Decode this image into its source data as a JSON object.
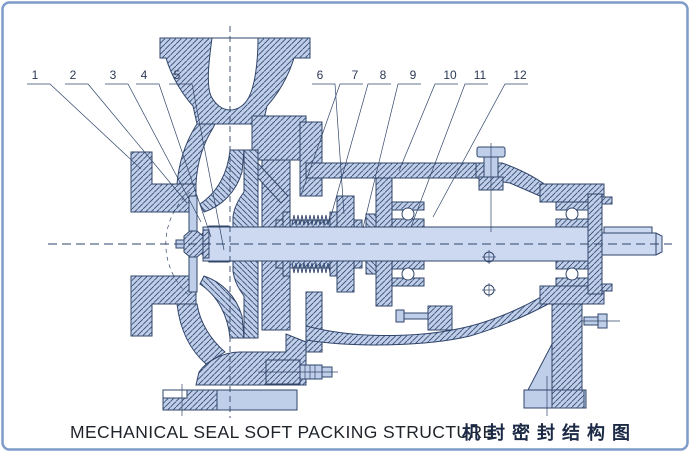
{
  "title": "Pump cross-section technical drawing",
  "caption": {
    "en": "MECHANICAL SEAL SOFT PACKING STRUCTURE",
    "zh": "机封密封结构图"
  },
  "callout_style": {
    "text_y": 79,
    "underline_y": 84
  },
  "callouts": [
    {
      "label": "1",
      "x": 35,
      "tx": 141,
      "ty": 169,
      "dir": "right"
    },
    {
      "label": "2",
      "x": 73,
      "tx": 187,
      "ty": 203,
      "dir": "right"
    },
    {
      "label": "3",
      "x": 113,
      "tx": 201,
      "ty": 222,
      "dir": "right"
    },
    {
      "label": "4",
      "x": 144,
      "tx": 211,
      "ty": 237,
      "dir": "right"
    },
    {
      "label": "5",
      "x": 177,
      "tx": 224,
      "ty": 250,
      "dir": "right"
    },
    {
      "label": "6",
      "x": 320,
      "tx": 344,
      "ty": 214,
      "dir": "right"
    },
    {
      "label": "7",
      "x": 355,
      "tx": 301,
      "ty": 195,
      "dir": "left"
    },
    {
      "label": "8",
      "x": 383,
      "tx": 331,
      "ty": 216,
      "dir": "left"
    },
    {
      "label": "9",
      "x": 413,
      "tx": 363,
      "ty": 228,
      "dir": "left"
    },
    {
      "label": "10",
      "x": 450,
      "tx": 399,
      "ty": 171,
      "dir": "left"
    },
    {
      "label": "11",
      "x": 480,
      "tx": 411,
      "ty": 227,
      "dir": "left"
    },
    {
      "label": "12",
      "x": 520,
      "tx": 433,
      "ty": 217,
      "dir": "left"
    }
  ],
  "colors": {
    "part_fill": "#bfcfea",
    "shaft_fill": "#ccd9f0",
    "line": "#32466b",
    "frame": "#7e9cc8",
    "background": "#ffffff",
    "caption_text": "#1f242b"
  }
}
